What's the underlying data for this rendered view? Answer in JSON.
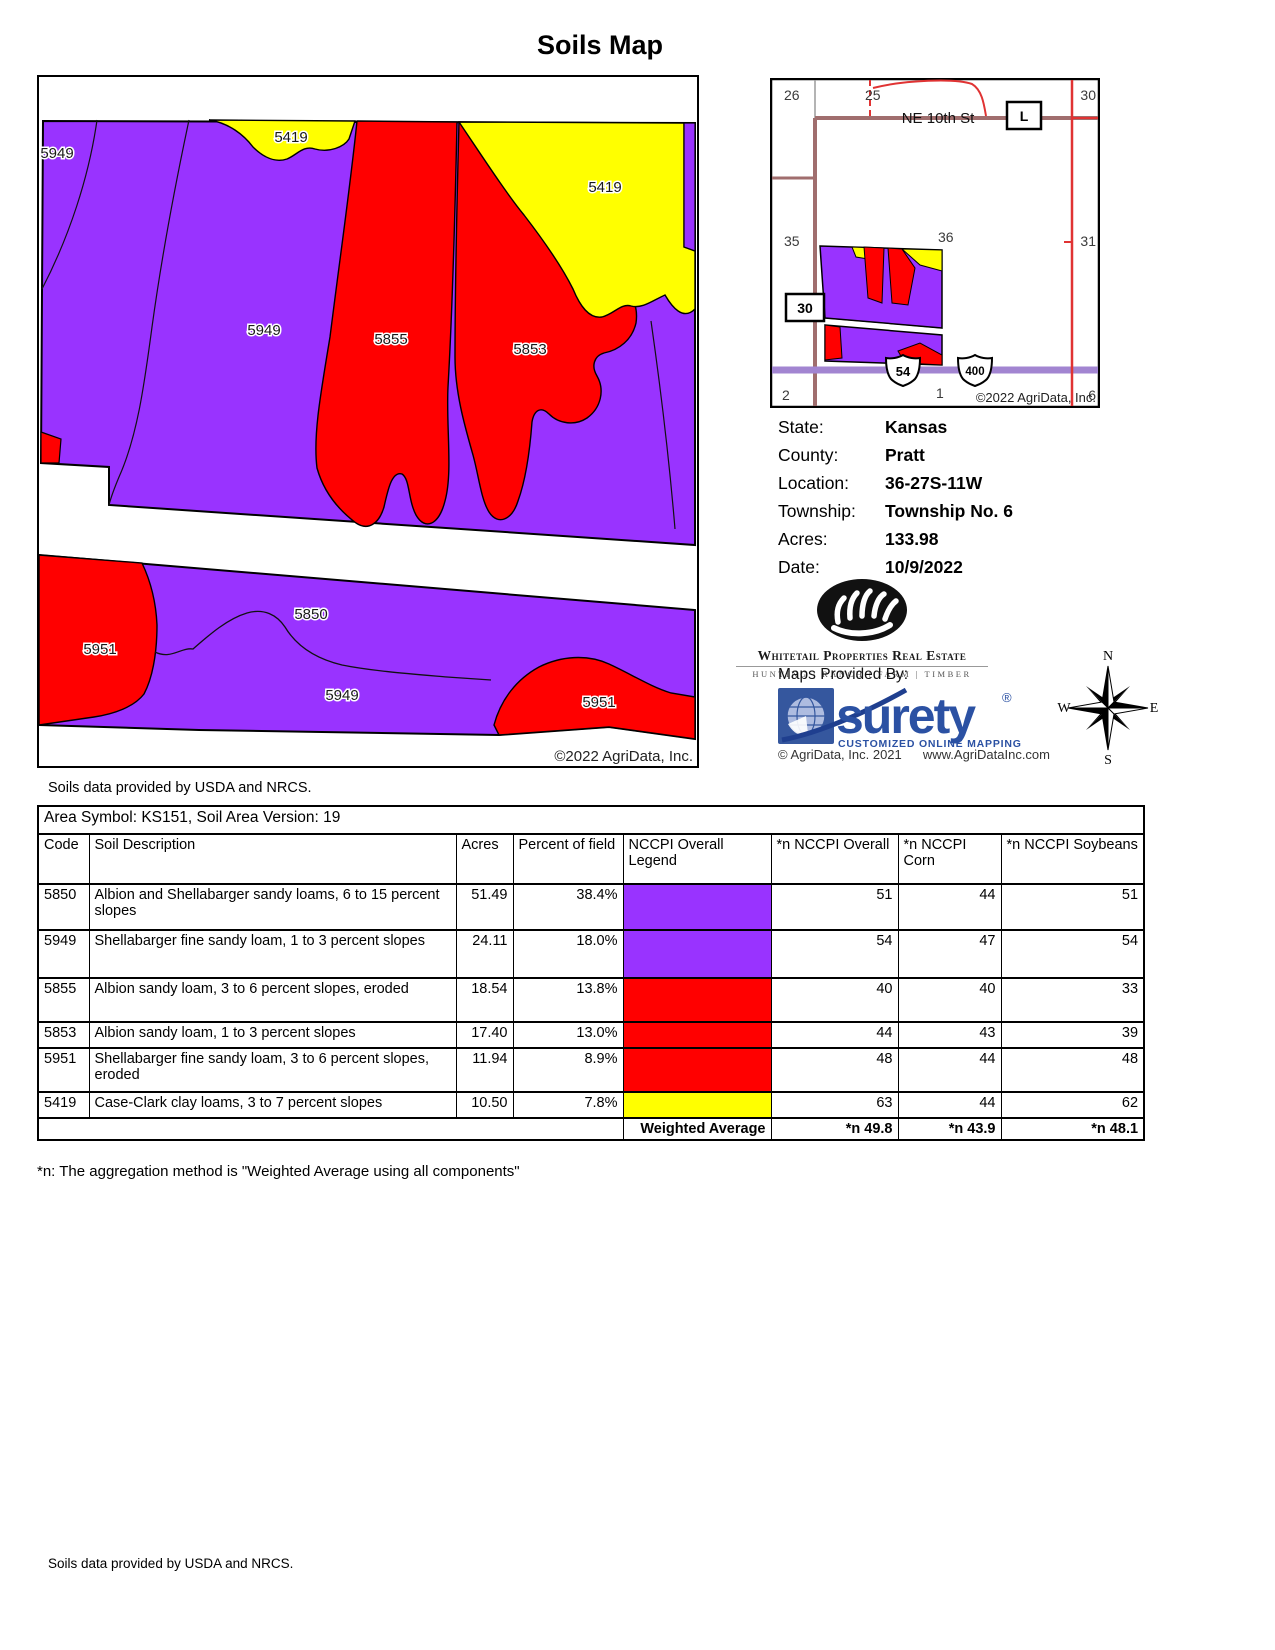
{
  "title": "Soils Map",
  "map": {
    "labels": [
      "5949",
      "5419",
      "5419",
      "5949",
      "5855",
      "5853",
      "5850",
      "5951",
      "5949",
      "5951"
    ],
    "copyright": "©2022 AgriData, Inc.",
    "colors": {
      "purple": "#9933FF",
      "red": "#FF0000",
      "yellow": "#FFFF00"
    }
  },
  "inset": {
    "sections": [
      "26",
      "25",
      "30",
      "35",
      "36",
      "31",
      "2",
      "1",
      "6"
    ],
    "street": "NE 10th St",
    "label_l": "L",
    "label_30": "30",
    "shield_54": "54",
    "shield_400": "400",
    "copyright": "©2022 AgriData, Inc.",
    "road_colors": {
      "brown": "#A06E6E",
      "highway_purple": "#A285D1",
      "red": "#E03333",
      "gray": "#9C9C9C"
    }
  },
  "info": {
    "rows": [
      {
        "label": "State:",
        "value": "Kansas"
      },
      {
        "label": "County:",
        "value": "Pratt"
      },
      {
        "label": "Location:",
        "value": "36-27S-11W"
      },
      {
        "label": "Township:",
        "value": "Township No. 6"
      },
      {
        "label": "Acres:",
        "value": "133.98"
      },
      {
        "label": "Date:",
        "value": "10/9/2022"
      }
    ]
  },
  "brand": {
    "name": "Whitetail Properties Real Estate",
    "tagline": "HUNTING | RANCH | FARM | TIMBER"
  },
  "surety": {
    "provided_by": "Maps Provided By:",
    "name": "surety",
    "reg": "®",
    "tagline": "CUSTOMIZED ONLINE MAPPING",
    "copyright": "© AgriData, Inc. 2021",
    "website": "www.AgriDataInc.com",
    "brand_blue": "#2B51A3"
  },
  "compass": {
    "n": "N",
    "e": "E",
    "s": "S",
    "w": "W"
  },
  "table": {
    "area_symbol": "Area Symbol: KS151, Soil Area Version: 19",
    "columns": [
      "Code",
      "Soil Description",
      "Acres",
      "Percent of field",
      "NCCPI Overall Legend",
      "*n NCCPI Overall",
      "*n NCCPI Corn",
      "*n NCCPI Soybeans"
    ],
    "rows": [
      {
        "code": "5850",
        "description": "Albion and Shellabarger sandy loams, 6 to 15 percent slopes",
        "acres": "51.49",
        "percent": "38.4%",
        "color": "#9933FF",
        "overall": "51",
        "corn": "44",
        "soybeans": "51"
      },
      {
        "code": "5949",
        "description": "Shellabarger fine sandy loam, 1 to 3 percent slopes",
        "acres": "24.11",
        "percent": "18.0%",
        "color": "#9933FF",
        "overall": "54",
        "corn": "47",
        "soybeans": "54"
      },
      {
        "code": "5855",
        "description": "Albion sandy loam, 3 to 6 percent slopes, eroded",
        "acres": "18.54",
        "percent": "13.8%",
        "color": "#FF0000",
        "overall": "40",
        "corn": "40",
        "soybeans": "33"
      },
      {
        "code": "5853",
        "description": "Albion sandy loam, 1 to 3 percent slopes",
        "acres": "17.40",
        "percent": "13.0%",
        "color": "#FF0000",
        "overall": "44",
        "corn": "43",
        "soybeans": "39"
      },
      {
        "code": "5951",
        "description": "Shellabarger fine sandy loam, 3 to 6 percent slopes, eroded",
        "acres": "11.94",
        "percent": "8.9%",
        "color": "#FF0000",
        "overall": "48",
        "corn": "44",
        "soybeans": "48"
      },
      {
        "code": "5419",
        "description": "Case-Clark clay loams, 3 to 7 percent slopes",
        "acres": "10.50",
        "percent": "7.8%",
        "color": "#FFFF00",
        "overall": "63",
        "corn": "44",
        "soybeans": "62"
      }
    ],
    "weighted_average": {
      "label": "Weighted Average",
      "overall": "*n 49.8",
      "corn": "*n 43.9",
      "soybeans": "*n 48.1"
    }
  },
  "notes": {
    "under_map": "Soils data provided by USDA and NRCS.",
    "footnote": "*n: The aggregation method is \"Weighted Average using all components\"",
    "bottom": "Soils data provided by USDA and NRCS."
  }
}
